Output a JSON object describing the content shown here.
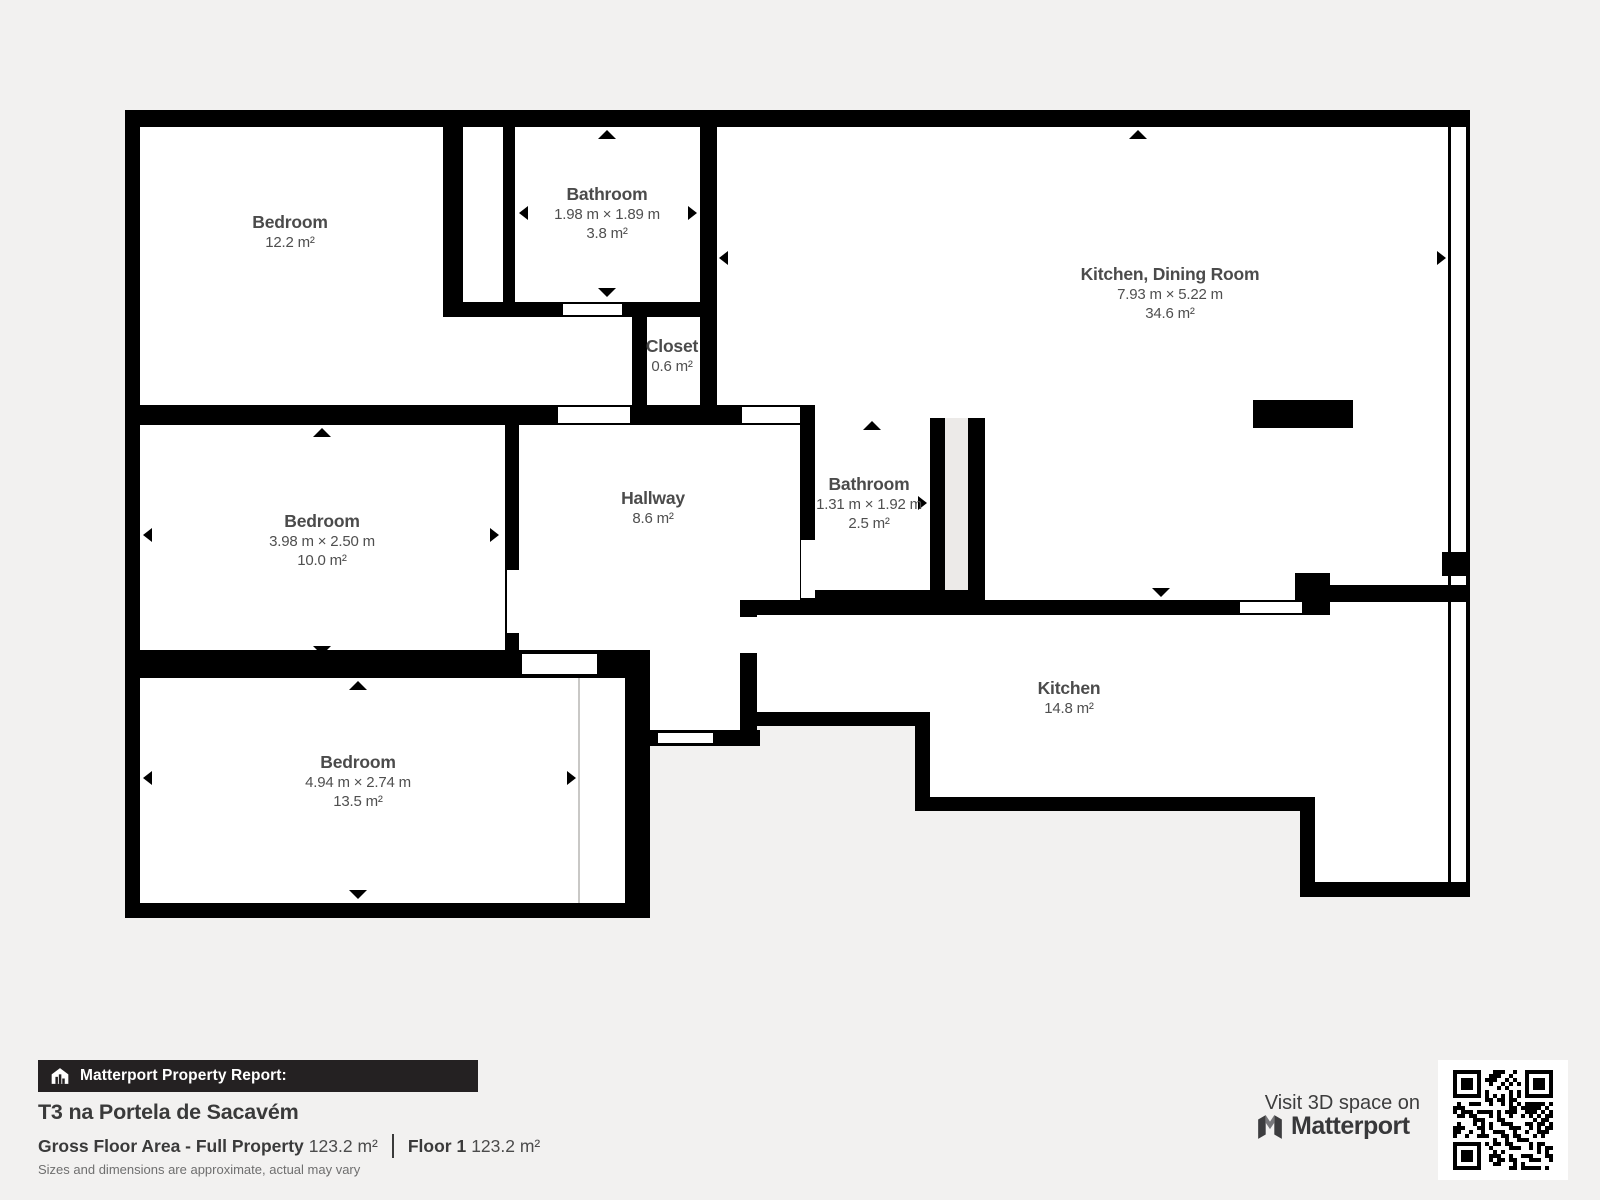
{
  "plan": {
    "rooms": [
      {
        "id": "bedroom-tl",
        "name": "Bedroom",
        "area": "12.2 m²"
      },
      {
        "id": "bathroom-tl",
        "name": "Bathroom",
        "dims": "1.98 m × 1.89 m",
        "area": "3.8 m²"
      },
      {
        "id": "kitchen-dining",
        "name": "Kitchen, Dining Room",
        "dims": "7.93 m × 5.22 m",
        "area": "34.6 m²"
      },
      {
        "id": "closet",
        "name": "Closet",
        "area": "0.6 m²"
      },
      {
        "id": "bedroom-ml",
        "name": "Bedroom",
        "dims": "3.98 m × 2.50 m",
        "area": "10.0 m²"
      },
      {
        "id": "hallway",
        "name": "Hallway",
        "area": "8.6 m²"
      },
      {
        "id": "bathroom-m",
        "name": "Bathroom",
        "dims": "1.31 m × 1.92 m",
        "area": "2.5 m²"
      },
      {
        "id": "bedroom-bl",
        "name": "Bedroom",
        "dims": "4.94 m × 2.74 m",
        "area": "13.5 m²"
      },
      {
        "id": "kitchen",
        "name": "Kitchen",
        "area": "14.8 m²"
      }
    ]
  },
  "report": {
    "banner": "Matterport Property Report:",
    "title": "T3 na Portela de Sacavém",
    "gfa_label": "Gross Floor Area - Full Property",
    "gfa_value": "123.2 m²",
    "floor_label": "Floor 1",
    "floor_value": "123.2 m²",
    "disclaimer": "Sizes and dimensions are approximate, actual may vary"
  },
  "footer_right": {
    "visit": "Visit 3D space on",
    "brand": "Matterport"
  },
  "icons": [
    "house-report-icon",
    "matterport-logo-icon",
    "qr-code"
  ],
  "colors": {
    "background": "#f2f1f0",
    "wall": "#000000",
    "room_fill": "#ffffff",
    "label_text": "#4b4b4b",
    "banner_bg": "#242122"
  }
}
